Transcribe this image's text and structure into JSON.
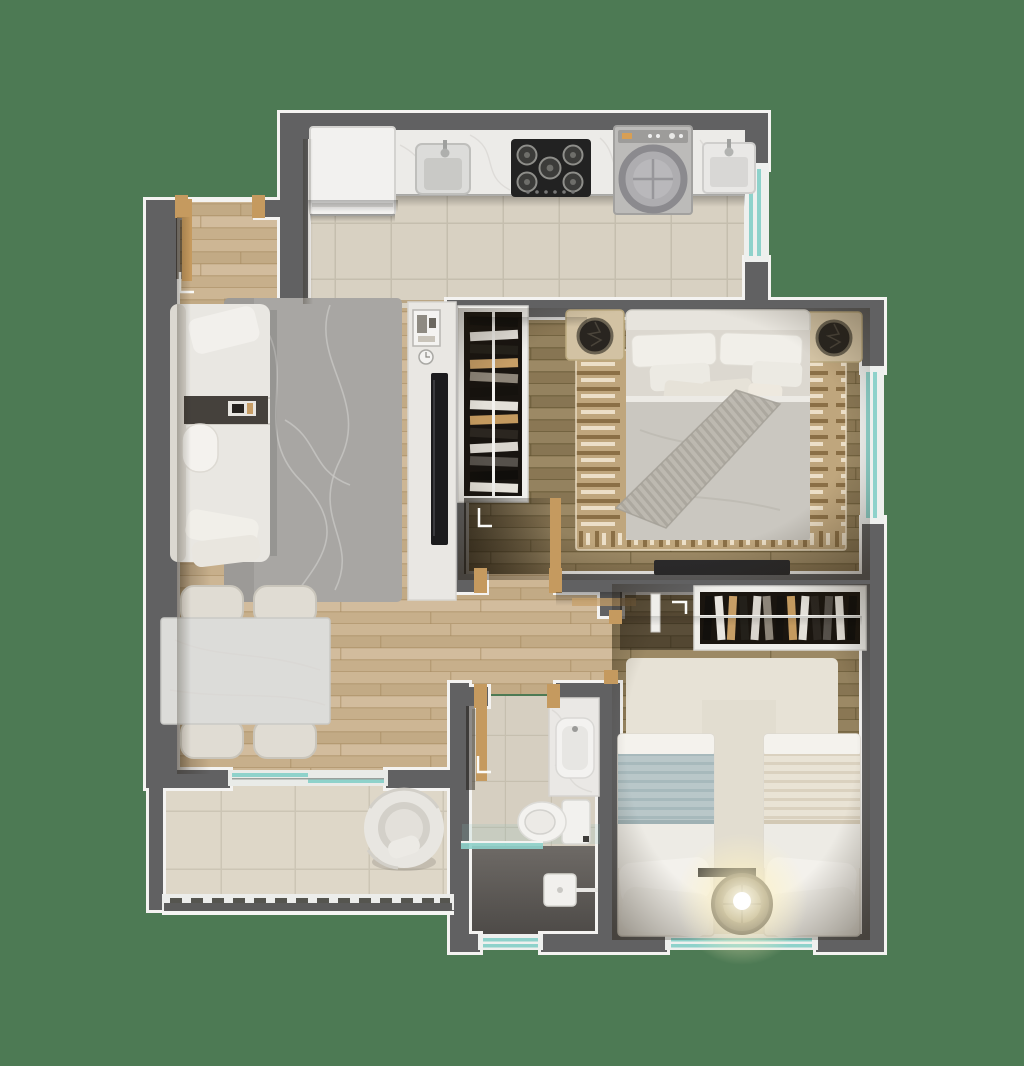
{
  "scene": {
    "type": "floor-plan-render",
    "description": "Photorealistic top-down 3D render of a two-bedroom apartment floor plan",
    "background_color": "#4d7a54"
  },
  "colors": {
    "background": "#4d7a54",
    "wall_fill": "#616162",
    "wall_stroke": "#f4f3f1",
    "wood_light": "#c9b28f",
    "wood_dark": "#8e7c5c",
    "tile_kitchen": "#d8d1c2",
    "tile_grout": "#c5beae",
    "tile_balcony": "#ded7c8",
    "tile_bath": "#d6cfc1",
    "shower_dark": "#5c5956",
    "glass_teal": "#8ed2cb",
    "rug_gray": "#a8a6a3",
    "rug_master": "#bfa67d",
    "rug_kilim_dark": "#8a6f46",
    "rug_kilim_light": "#ecdfc8",
    "rug_white": "#e7e2d6",
    "furniture_white": "#e9e7e2",
    "cushion": "#dcd8d0",
    "marble": "#ecebe8",
    "stove_black": "#222222",
    "appliance_gray": "#bcbbb9",
    "door_wood": "#c59a5f",
    "wardrobe_dark": "#1a150f",
    "blanket_gray": "#cac7c0",
    "blanket_blue": "#b9c7c9",
    "blanket_beige": "#e9e3d5",
    "lamp_glow": "#fff3c4",
    "tv_black": "#1b1b1d",
    "tray_dark": "#45413c",
    "nightstand_tan": "#d2c2a3"
  },
  "rooms": [
    {
      "name": "kitchen-laundry",
      "furniture": [
        "refrigerator",
        "countertop",
        "kitchen-sink",
        "cooktop-5-burner",
        "washing-machine",
        "laundry-sink",
        "window"
      ]
    },
    {
      "name": "living-dining",
      "furniture": [
        "sofa",
        "throw-pillows",
        "area-rug",
        "tv-panel",
        "tv",
        "dining-table",
        "dining-chairs",
        "entry-door"
      ]
    },
    {
      "name": "master-bedroom",
      "furniture": [
        "double-bed",
        "headboard",
        "pillows",
        "nightstand-left",
        "nightstand-right",
        "open-wardrobe",
        "patterned-rug",
        "tv-bench",
        "window",
        "door"
      ]
    },
    {
      "name": "second-bedroom",
      "furniture": [
        "single-bed-blue",
        "single-bed-beige",
        "open-closet",
        "runner-rug",
        "round-lamp-table",
        "wall-shelf",
        "window",
        "door"
      ]
    },
    {
      "name": "bathroom",
      "furniture": [
        "vanity-counter",
        "sink",
        "toilet",
        "shower",
        "glass-partition",
        "window",
        "door"
      ]
    },
    {
      "name": "balcony",
      "furniture": [
        "round-armchair",
        "glass-railing",
        "sliding-door"
      ]
    }
  ]
}
